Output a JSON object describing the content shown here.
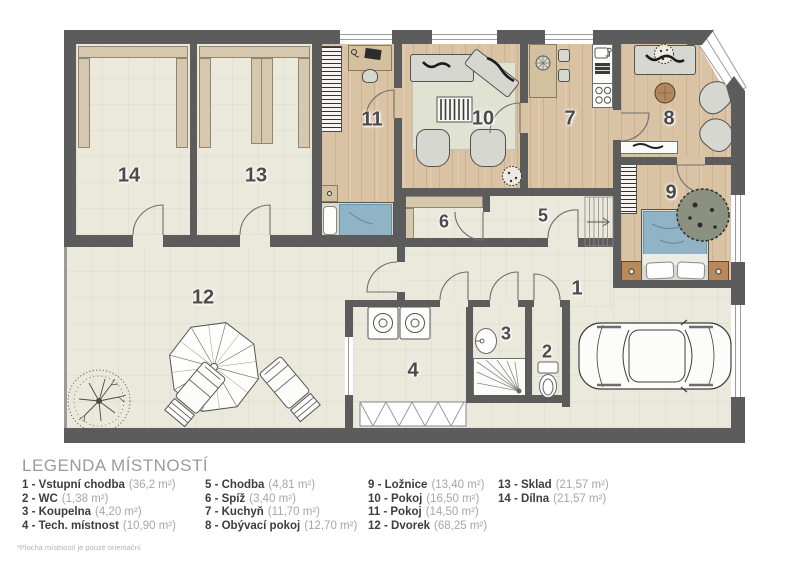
{
  "plan": {
    "labels": [
      {
        "number": "1"
      },
      {
        "number": "2"
      },
      {
        "number": "3"
      },
      {
        "number": "4"
      },
      {
        "number": "5"
      },
      {
        "number": "6"
      },
      {
        "number": "7"
      },
      {
        "number": "8"
      },
      {
        "number": "9"
      },
      {
        "number": "10"
      },
      {
        "number": "11"
      },
      {
        "number": "12"
      },
      {
        "number": "13"
      },
      {
        "number": "14"
      }
    ],
    "icons": [
      {
        "name": "car-icon"
      },
      {
        "name": "tree-icon"
      },
      {
        "name": "umbrella-icon"
      },
      {
        "name": "lounger-icon"
      },
      {
        "name": "bed-icon"
      },
      {
        "name": "sofa-icon"
      },
      {
        "name": "shower-icon"
      },
      {
        "name": "toilet-icon"
      },
      {
        "name": "washer-icon"
      },
      {
        "name": "stove-icon"
      },
      {
        "name": "stairs-icon"
      }
    ],
    "colors": {
      "wall": "#5c5c5c",
      "wood_floor": "#d9c3a4",
      "cream_floor": "#ebe8dc",
      "bed_blue": "#90b4c6",
      "rug_green": "#e0e3d2"
    }
  },
  "legend": {
    "title": "LEGENDA MÍSTNOSTÍ",
    "footnote": "*Plocha místností je pouze orientační",
    "items": [
      {
        "label": "1 - Vstupní chodba",
        "area": "(36,2 m²)"
      },
      {
        "label": "2 - WC",
        "area": "(1,38 m²)"
      },
      {
        "label": "3 - Koupelna",
        "area": "(4,20 m²)"
      },
      {
        "label": "4 - Tech. místnost",
        "area": "(10,90 m²)"
      },
      {
        "label": "5 - Chodba",
        "area": "(4,81 m²)"
      },
      {
        "label": "6 - Spíž",
        "area": "(3,40 m²)"
      },
      {
        "label": "7 - Kuchyň",
        "area": "(11,70 m²)"
      },
      {
        "label": "8 - Obývací pokoj",
        "area": "(12,70 m²)"
      },
      {
        "label": "9 - Ložnice",
        "area": "(13,40 m²)"
      },
      {
        "label": "10 - Pokoj",
        "area": "(16,50 m²)"
      },
      {
        "label": "11 - Pokoj",
        "area": "(14,50 m²)"
      },
      {
        "label": "12 - Dvorek",
        "area": "(68,25 m²)"
      },
      {
        "label": "13 - Sklad",
        "area": "(21,57 m²)"
      },
      {
        "label": "14 - Dílna",
        "area": "(21,57 m²)"
      }
    ]
  }
}
